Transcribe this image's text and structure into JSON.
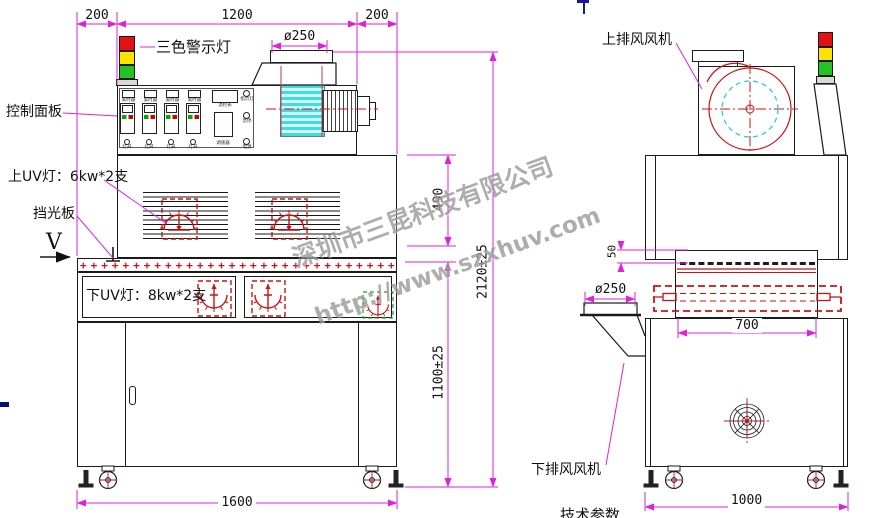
{
  "front_view": {
    "dims": {
      "top_left": "200",
      "top_mid": "1200",
      "top_right": "200",
      "duct_dia": "ø250",
      "chamber_h": "490",
      "total_h": "2120±25",
      "table_h": "1100±25",
      "width": "1600"
    },
    "labels": {
      "tower": "三色警示灯",
      "panel": "控制面板",
      "upper_uv": "上UV灯：6kw*2支",
      "baffle": "挡光板",
      "view": "V",
      "lower_uv": "下UV灯：8kw*2支"
    },
    "panel": {
      "timer": "累时器",
      "meter": "温控表",
      "lamp_btn": "灯开",
      "speed": "调速器",
      "ind": "指示灯",
      "stop": "急停",
      "power": "电源"
    },
    "conveyor_clips": "++++++++++++++++++++++++++++++"
  },
  "side_view": {
    "dims": {
      "gap": "50",
      "duct_dia": "ø250",
      "belt": "700",
      "depth": "1000"
    },
    "labels": {
      "top_fan": "上排风风机",
      "bottom_fan": "下排风风机"
    }
  },
  "watermark": {
    "company": "深圳市三昆科技有限公司",
    "url": "http://www.szxhuv.com"
  },
  "footer": {
    "cut_text": "技术参数"
  }
}
